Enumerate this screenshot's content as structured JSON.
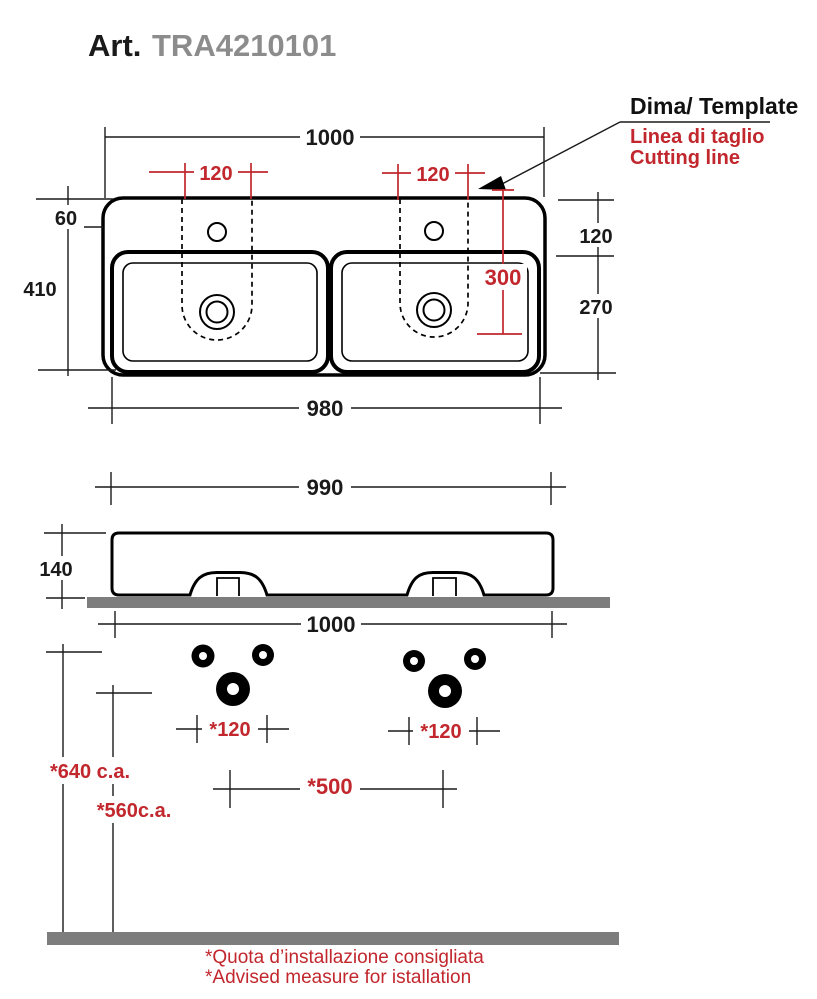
{
  "title": {
    "prefix": "Art.",
    "code": "TRA4210101"
  },
  "template_note": {
    "heading": "Dima/ Template",
    "line1": "Linea di taglio",
    "line2": "Cutting line"
  },
  "top_view": {
    "width_top": "1000",
    "faucet_span_left": "120",
    "faucet_span_right": "120",
    "edge_to_faucet": "60",
    "overall_depth": "410",
    "rim_to_basin": "120",
    "basin_depth": "270",
    "cut_depth": "300",
    "width_bottom": "980"
  },
  "side_view": {
    "width_top": "990",
    "height": "140",
    "width_bottom": "1000"
  },
  "installation": {
    "hole_span_left": "*120",
    "hole_span_right": "*120",
    "hole_centers": "*500",
    "upper_height": "*640 c.a.",
    "lower_height": "*560c.a."
  },
  "footer": {
    "note_it": "*Quota d’installazione consigliata",
    "note_en": "*Advised measure for istallation"
  },
  "colors": {
    "dimension_red": "#C1272D",
    "bar_gray": "#7D7D7D",
    "title_code_gray": "#8C8C8C",
    "line_black": "#000000"
  }
}
